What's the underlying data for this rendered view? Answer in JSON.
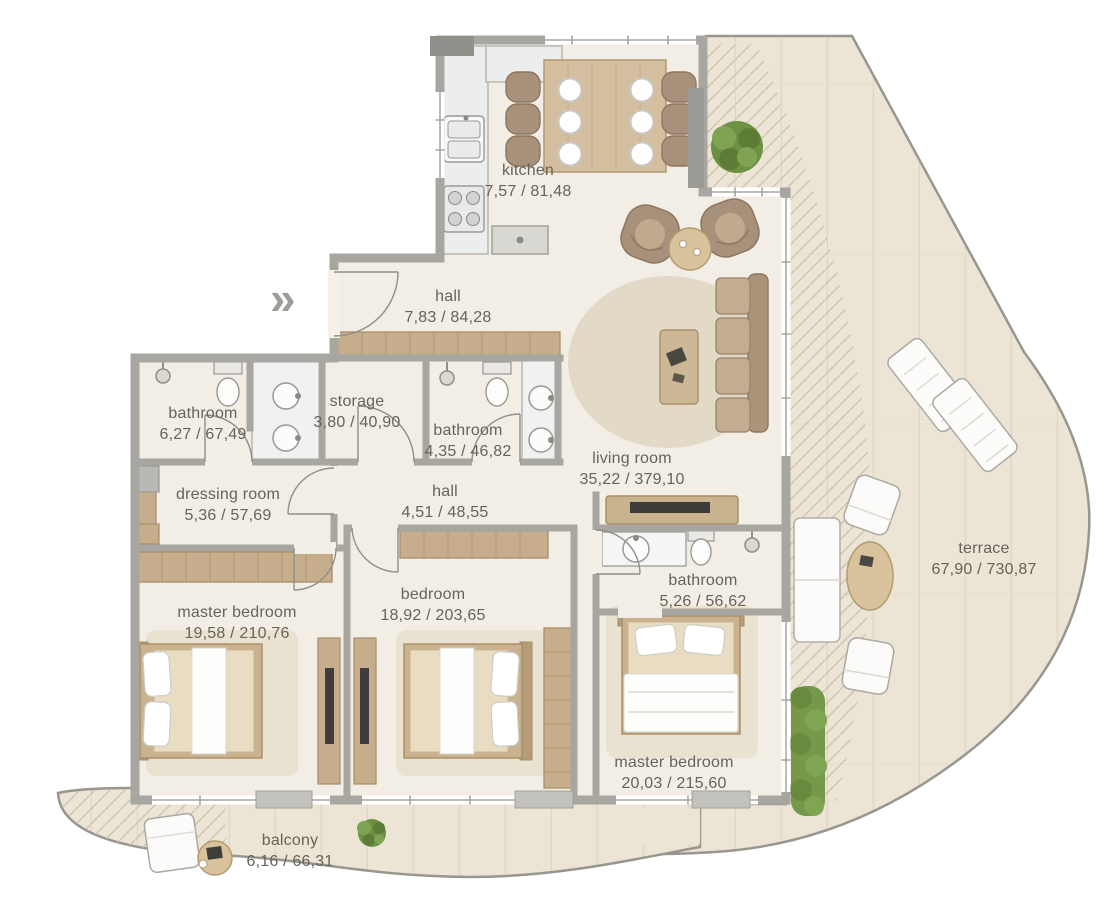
{
  "plan": {
    "title": "apartment floor plan",
    "entry_marker": "»",
    "rooms": [
      {
        "name": "kitchen",
        "area": "7,57 / 81,48"
      },
      {
        "name": "hall",
        "area": "7,83 / 84,28"
      },
      {
        "name": "bathroom",
        "area": "6,27 / 67,49"
      },
      {
        "name": "storage",
        "area": "3,80 / 40,90"
      },
      {
        "name": "bathroom",
        "area": "4,35 / 46,82"
      },
      {
        "name": "hall",
        "area": "4,51 / 48,55"
      },
      {
        "name": "dressing room",
        "area": "5,36 / 57,69"
      },
      {
        "name": "living room",
        "area": "35,22 / 379,10"
      },
      {
        "name": "master bedroom",
        "area": "19,58 / 210,76"
      },
      {
        "name": "bedroom",
        "area": "18,92 / 203,65"
      },
      {
        "name": "bathroom",
        "area": "5,26 / 56,62"
      },
      {
        "name": "master bedroom",
        "area": "20,03 / 215,60"
      },
      {
        "name": "terrace",
        "area": "67,90 / 730,87"
      },
      {
        "name": "balcony",
        "area": "6,16 / 66,31"
      }
    ],
    "colors": {
      "wall": "#a7a6a0",
      "floor": "#f3eee5",
      "terrace": "#ece4d5",
      "wood": "#c9b28d",
      "sofa": "#b7a189",
      "plant": "#6d9142",
      "label_text": "#67625a"
    }
  }
}
